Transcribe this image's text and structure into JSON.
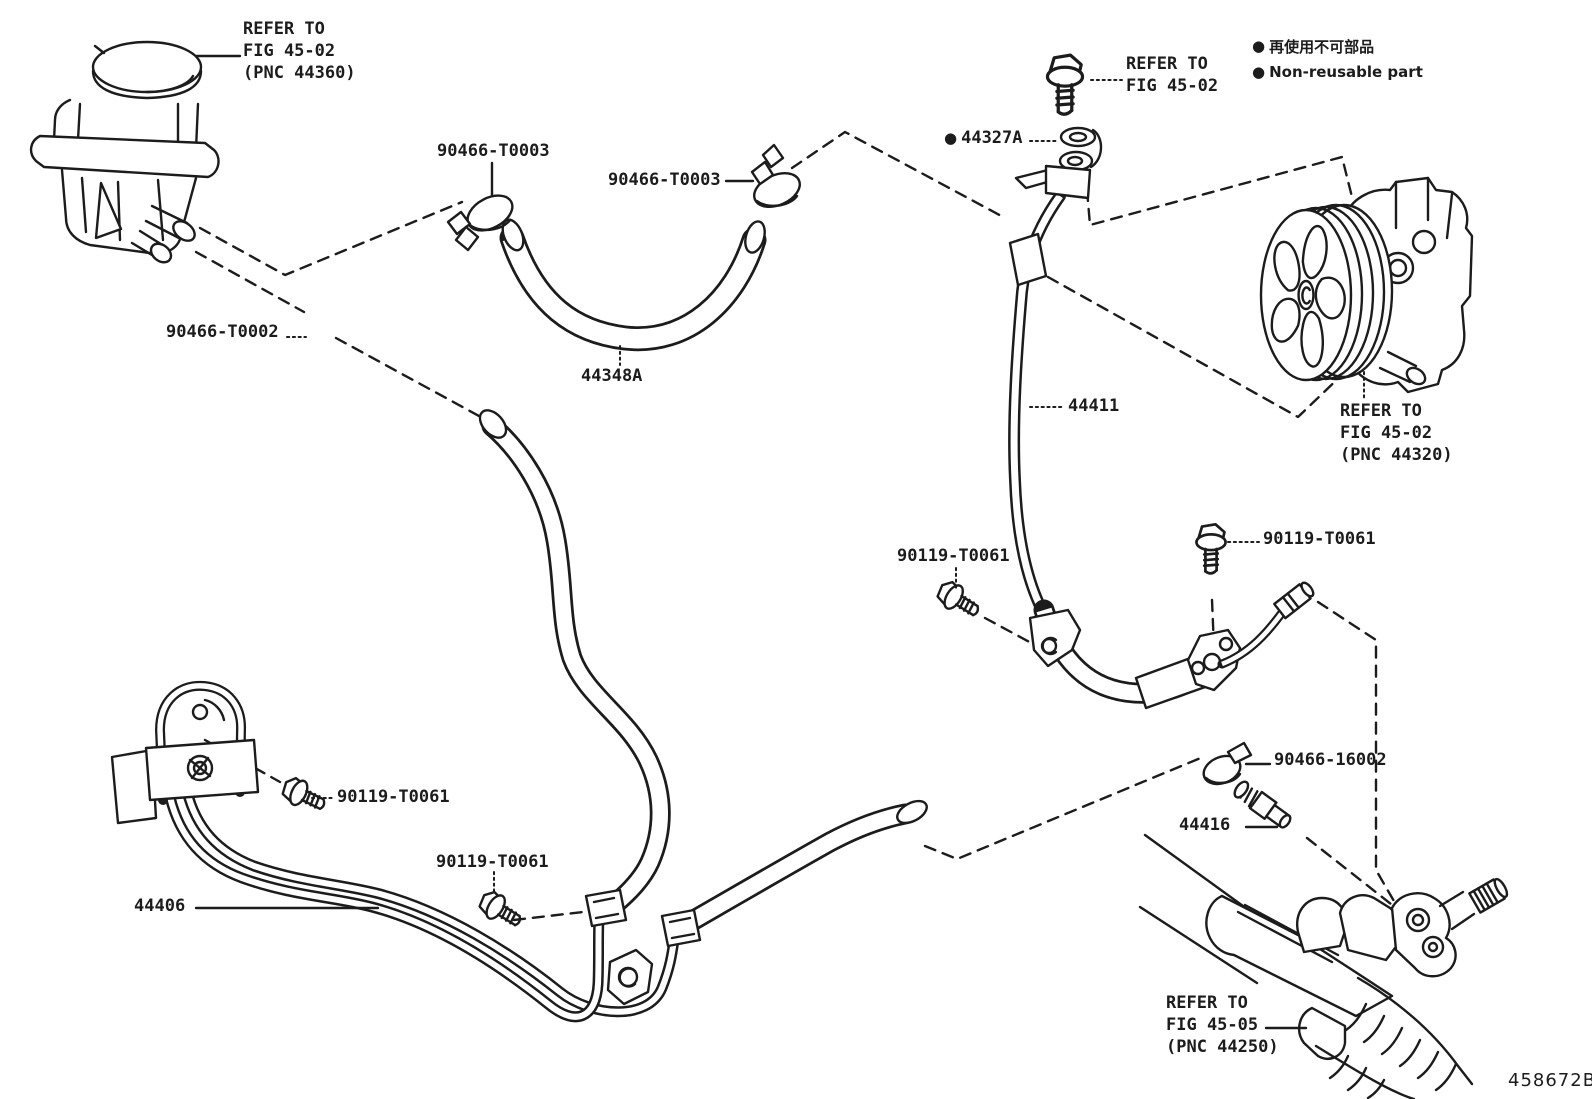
{
  "diagram": {
    "number": "458672B",
    "legend": {
      "bullet": "●",
      "jp": "再使用不可部品",
      "en": "Non-reusable part"
    },
    "labels": {
      "refer_44360": {
        "lines": [
          "REFER TO",
          "FIG 45-02",
          "(PNC 44360)"
        ]
      },
      "refer_4502_top": {
        "lines": [
          "REFER TO",
          "FIG 45-02"
        ]
      },
      "refer_44320": {
        "lines": [
          "REFER TO",
          "FIG 45-02",
          "(PNC 44320)"
        ]
      },
      "refer_44250": {
        "lines": [
          "REFER TO",
          "FIG 45-05",
          "(PNC 44250)"
        ]
      },
      "clamp_t0003_left": "90466-T0003",
      "clamp_t0003_right": "90466-T0003",
      "clamp_t0002": "90466-T0002",
      "hose_44348a": "44348A",
      "part_44327a": "44327A",
      "tube_44411": "44411",
      "bolt_mid": "90119-T0061",
      "bolt_right": "90119-T0061",
      "bolt_left": "90119-T0061",
      "bolt_center": "90119-T0061",
      "clamp_16002": "90466-16002",
      "union_44416": "44416",
      "tube_44406": "44406"
    },
    "colors": {
      "line": "#1c1c1c",
      "background": "#ffffff"
    }
  }
}
